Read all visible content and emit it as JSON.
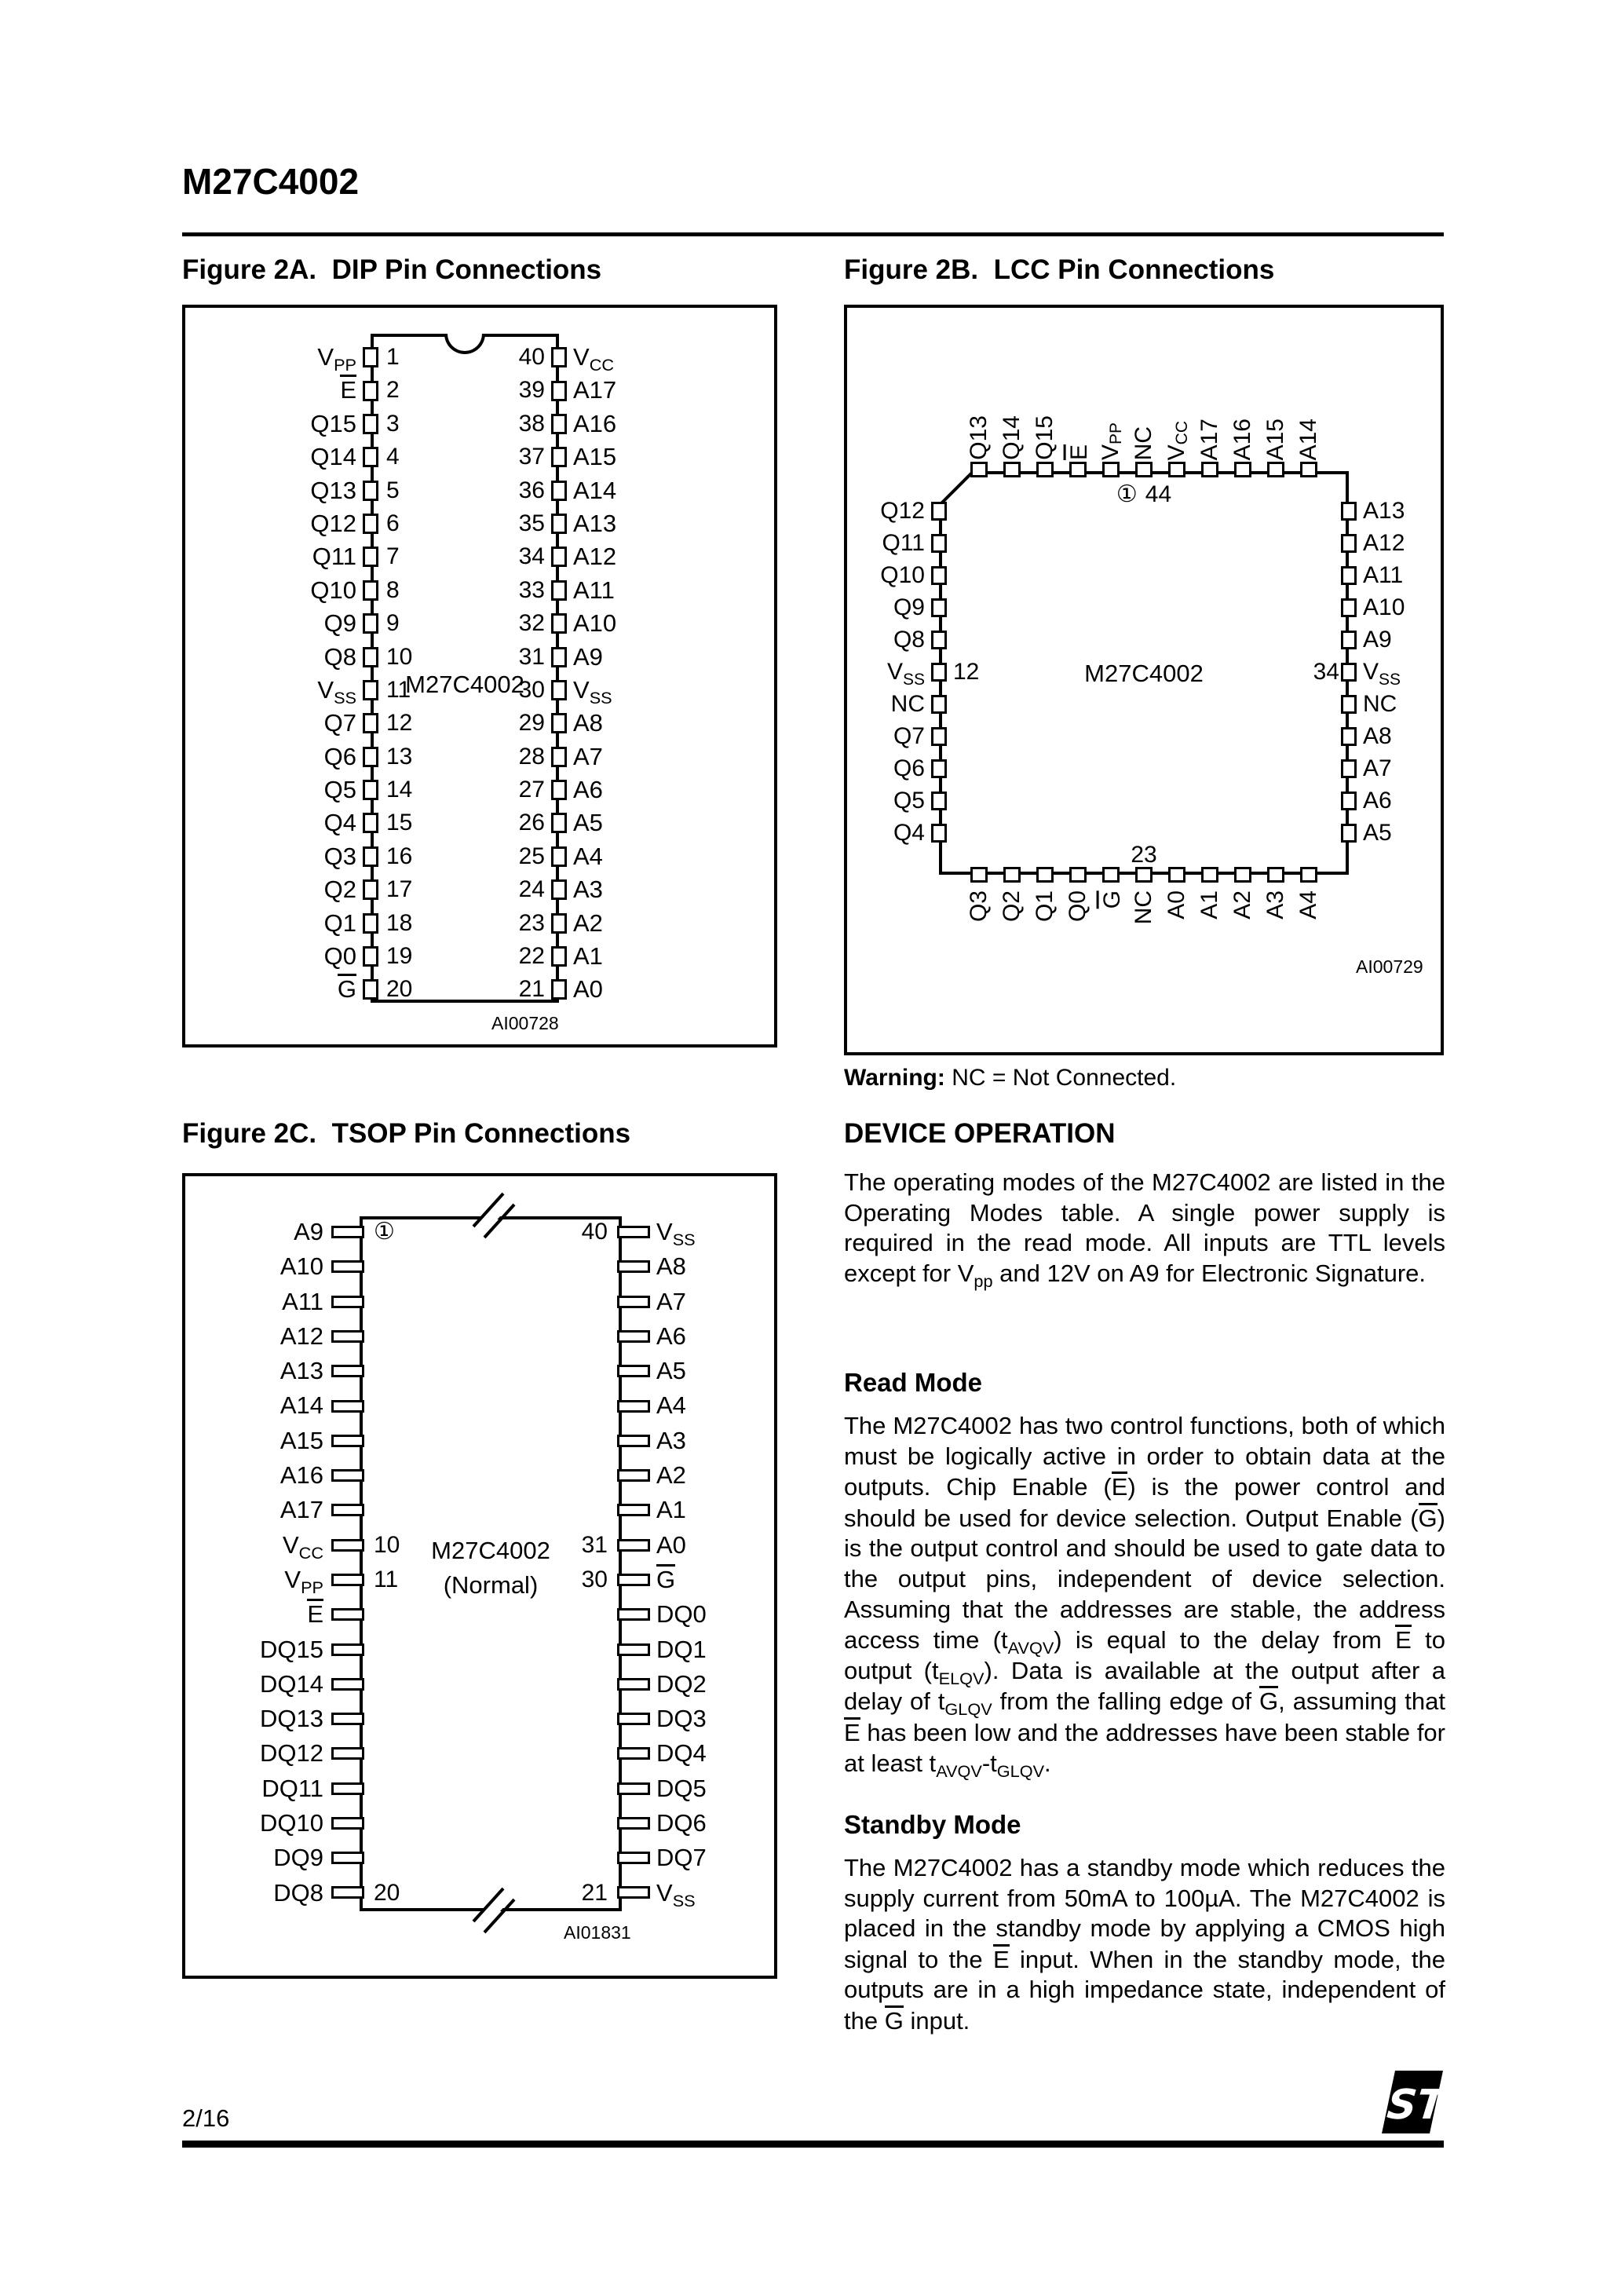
{
  "header": {
    "part_number": "M27C4002"
  },
  "figure_2a": {
    "title": "Figure 2A.  DIP Pin Connections",
    "chip_label": "M27C4002",
    "figure_code": "AI00728",
    "left_labels": [
      "V{PP}",
      "~E~",
      "Q15",
      "Q14",
      "Q13",
      "Q12",
      "Q11",
      "Q10",
      "Q9",
      "Q8",
      "V{SS}",
      "Q7",
      "Q6",
      "Q5",
      "Q4",
      "Q3",
      "Q2",
      "Q1",
      "Q0",
      "~G~"
    ],
    "left_numbers": [
      "1",
      "2",
      "3",
      "4",
      "5",
      "6",
      "7",
      "8",
      "9",
      "10",
      "11",
      "12",
      "13",
      "14",
      "15",
      "16",
      "17",
      "18",
      "19",
      "20"
    ],
    "right_numbers": [
      "40",
      "39",
      "38",
      "37",
      "36",
      "35",
      "34",
      "33",
      "32",
      "31",
      "30",
      "29",
      "28",
      "27",
      "26",
      "25",
      "24",
      "23",
      "22",
      "21"
    ],
    "right_labels": [
      "V{CC}",
      "A17",
      "A16",
      "A15",
      "A14",
      "A13",
      "A12",
      "A11",
      "A10",
      "A9",
      "V{SS}",
      "A8",
      "A7",
      "A6",
      "A5",
      "A4",
      "A3",
      "A2",
      "A1",
      "A0"
    ]
  },
  "figure_2b": {
    "title": "Figure 2B.  LCC Pin Connections",
    "chip_label": "M27C4002",
    "figure_code": "AI00729",
    "pin1_marker": "①",
    "pin44_label": "44",
    "pin23_label": "23",
    "top_labels": [
      "Q13",
      "Q14",
      "Q15",
      "~E~",
      "V{PP}",
      "NC",
      "V{CC}",
      "A17",
      "A16",
      "A15",
      "A14"
    ],
    "left_labels": [
      "Q12",
      "Q11",
      "Q10",
      "Q9",
      "Q8",
      "V{SS}",
      "NC",
      "Q7",
      "Q6",
      "Q5",
      "Q4"
    ],
    "left_numbers": [
      "",
      "",
      "",
      "",
      "",
      "12",
      "",
      "",
      "",
      "",
      ""
    ],
    "right_labels": [
      "A13",
      "A12",
      "A11",
      "A10",
      "A9",
      "V{SS}",
      "NC",
      "A8",
      "A7",
      "A6",
      "A5"
    ],
    "right_numbers": [
      "",
      "",
      "",
      "",
      "",
      "34",
      "",
      "",
      "",
      "",
      ""
    ],
    "bottom_labels": [
      "Q3",
      "Q2",
      "Q1",
      "Q0",
      "~G~",
      "NC",
      "A0",
      "A1",
      "A2",
      "A3",
      "A4"
    ],
    "warning_bold": "Warning:",
    "warning_text": " NC = Not Connected."
  },
  "figure_2c": {
    "title": "Figure 2C.  TSOP Pin Connections",
    "chip_label_line1": "M27C4002",
    "chip_label_line2": "(Normal)",
    "figure_code": "AI01831",
    "left_labels": [
      "A9",
      "A10",
      "A11",
      "A12",
      "A13",
      "A14",
      "A15",
      "A16",
      "A17",
      "V{CC}",
      "V{PP}",
      "~E~",
      "DQ15",
      "DQ14",
      "DQ13",
      "DQ12",
      "DQ11",
      "DQ10",
      "DQ9",
      "DQ8"
    ],
    "left_numbers": [
      "①",
      "",
      "",
      "",
      "",
      "",
      "",
      "",
      "",
      "10",
      "11",
      "",
      "",
      "",
      "",
      "",
      "",
      "",
      "",
      "20"
    ],
    "right_numbers": [
      "40",
      "",
      "",
      "",
      "",
      "",
      "",
      "",
      "",
      "31",
      "30",
      "",
      "",
      "",
      "",
      "",
      "",
      "",
      "",
      "21"
    ],
    "right_labels": [
      "V{SS}",
      "A8",
      "A7",
      "A6",
      "A5",
      "A4",
      "A3",
      "A2",
      "A1",
      "A0",
      "~G~",
      "DQ0",
      "DQ1",
      "DQ2",
      "DQ3",
      "DQ4",
      "DQ5",
      "DQ6",
      "DQ7",
      "V{SS}"
    ]
  },
  "device_operation": {
    "heading": "DEVICE OPERATION",
    "intro": "The operating modes of the M27C4002 are listed in the Operating Modes table. A single power supply is required in the read mode.  All inputs are TTL levels except for V{pp} and 12V on A9 for Electronic Signature.",
    "read_mode_heading": "Read Mode",
    "read_mode_text": "The M27C4002 has two control functions, both of which must be logically active in order to obtain data at the outputs.  Chip Enable (~E~) is the power control and should be used for device selection. Output Enable (~G~) is the output control and should be used to gate data to the output pins, independent of device selection.  Assuming that the addresses are stable, the address access time (t{AVQV}) is equal to the delay from ~E~ to output (t{ELQV}). Data is available at the output after a delay of t{GLQV} from the falling edge of ~G~, assuming that ~E~ has been low and the addresses have been stable for at least t{AVQV}-t{GLQV}.",
    "standby_mode_heading": "Standby Mode",
    "standby_mode_text": "The M27C4002 has a standby mode which reduces the supply current from 50mA to 100µA. The M27C4002 is placed in the standby mode by applying a CMOS high signal to the ~E~ input.  When in the standby mode, the outputs are in a high impedance state, independent of the ~G~ input."
  },
  "footer": {
    "page_number": "2/16",
    "logo_text": "ST"
  }
}
